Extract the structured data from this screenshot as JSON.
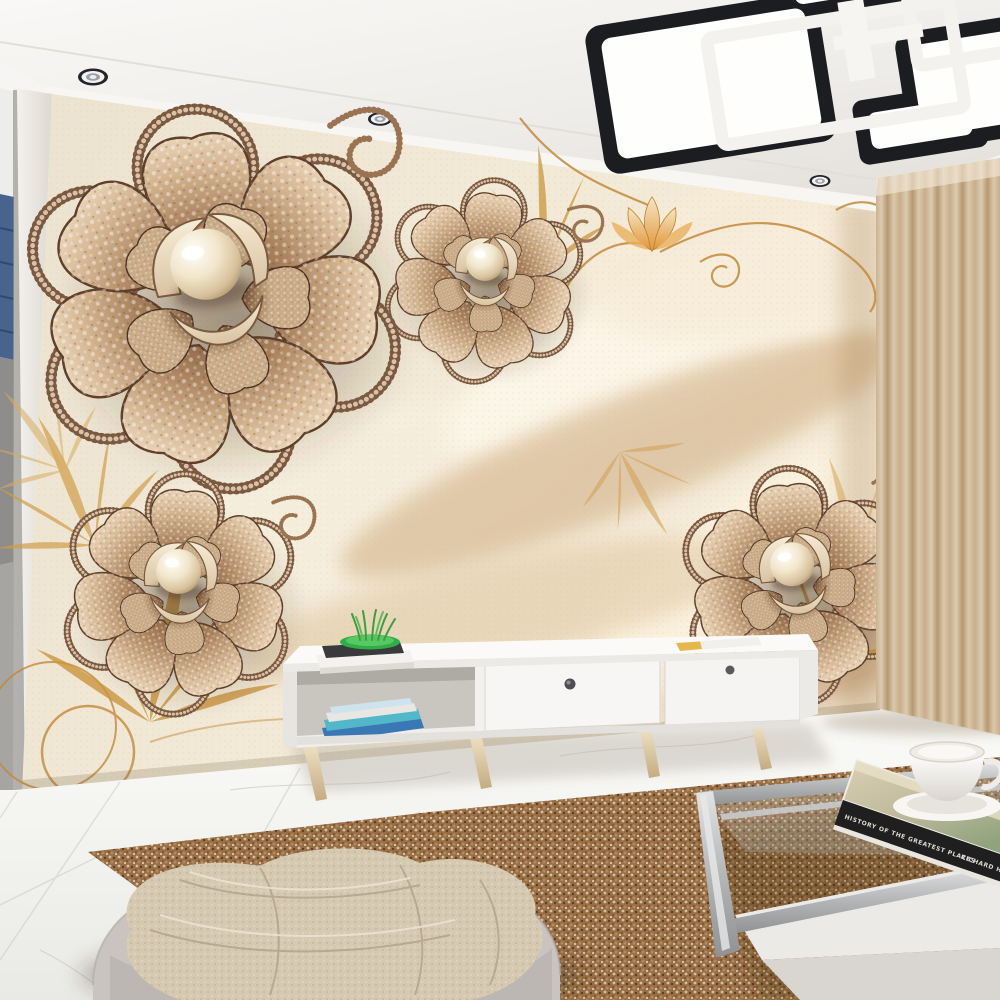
{
  "scene": {
    "description": "Photorealistic living-room interior render with a 3D jewelled-rose and pearl silk mural wallpaper",
    "wall_mural": {
      "motif": "four diamond-encrusted bronze roses with large central pearls on draped cream silk with golden vines, lotus and leaf fronds",
      "flower_count": 4,
      "pearl_color": "#f2e6cc",
      "bronze_color": "#8d6847",
      "gold_accent": "#c28a3c",
      "silk_color": "#f3e8d2"
    },
    "lighting": {
      "ceiling_fixture": "modern geometric flush-mount, overlapping black boxes with white light panels and white open frames",
      "fixture_black": "#1b1d20",
      "recessed_spotlights": 4
    },
    "furniture": {
      "tv_stand": "low white media console with open shelf, two drawers, tapered light-wood legs",
      "coffee_table": "silver metal frame table with glass top and white lower shelf",
      "pouf": "round light-grey fabric ottoman with beige knit blanket",
      "rug": "brown speckled area rug",
      "curtain": "pleated beige floor curtain",
      "floor": "white marble tiles"
    }
  },
  "book": {
    "title": "HISTORY OF THE GREATEST PLACES",
    "author": "RICHARD HOCH"
  },
  "palette": {
    "ceiling": "#f4f2ef",
    "curtain": "#e7d2b2",
    "rug_base": "#a97c4f",
    "marble": "#f4f3f1",
    "pouf": "#c9c4c0",
    "blanket": "#d5c9b1",
    "wood_leg": "#dcc69e",
    "drawer_knob": "#4e4e50",
    "plant_green": "#3fae4c",
    "magazine_blue": "#3a77b5",
    "magazine_teal": "#52b7c9",
    "side_shade_blue": "#46648e"
  }
}
